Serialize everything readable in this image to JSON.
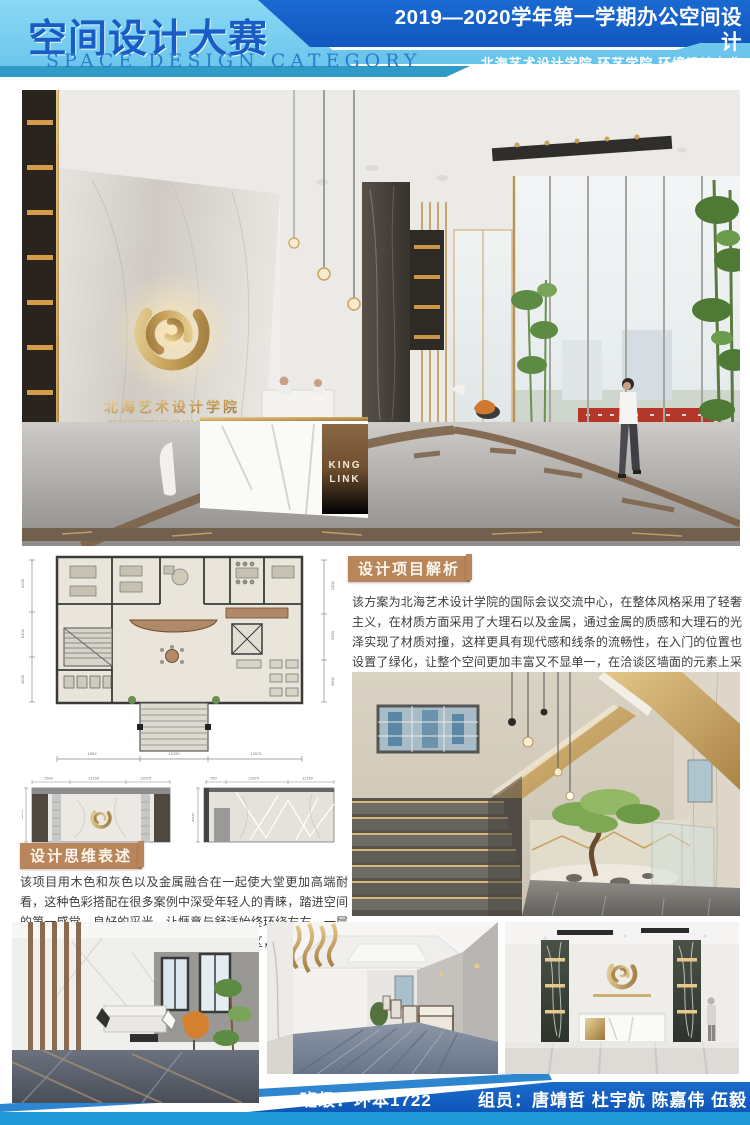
{
  "header": {
    "title_cn": "空间设计大赛",
    "title_en": "SPACE DESIGN CATEGORY",
    "course_line": "2019—2020学年第一学期办公空间设计",
    "school_line": "北海艺术设计学院 环艺学院 环境设计专业"
  },
  "brand": {
    "logo_name_cn": "北海艺术设计学院",
    "logo_name_en": "BEIHAI UNIVERSITY OF ART AND DESIGN",
    "desk_sign_line1": "KING",
    "desk_sign_line2": "LINK"
  },
  "sections": {
    "analysis": {
      "label": "设计项目解析",
      "body": "该方案为北海艺术设计学院的国际会议交流中心，在整体风格采用了轻奢主义，在材质方面采用了大理石以及金属，通过金属的质感和大理石的光泽实现了材质对撞，这样更具有现代感和线条的流畅性，在入门的位置也设置了绿化，让整个空间更加丰富又不显单一，在洽谈区墙面的元素上采用了多边形切割的方式。"
    },
    "thinking": {
      "label": "设计思维表述",
      "body": "该项目用木色和灰色以及金属融合在一起使大堂更加高端耐看，这种色彩搭配在很多案例中深受年轻人的青睐，踏进空间的第一感觉，良好的采光，让惬意与舒适始终环绕左右，一层主要分为客户接待区、等候区以及大堂展示区，在楼梯入口处也添加了植物配景，凸显大自然的元素。"
    }
  },
  "floor_plan": {
    "bottom_dims": [
      "1500",
      "12150",
      "13575"
    ],
    "left_dims": [
      "4200",
      "8100",
      "4500"
    ],
    "right_dims": [
      "2400",
      "9300",
      "3900"
    ]
  },
  "elevations": {
    "left": {
      "top_dims": [
        "1500",
        "12150",
        "13575"
      ],
      "side_dim": "2800"
    },
    "right": {
      "top_dims": [
        "750",
        "13575",
        "12150"
      ],
      "side_dim": "3000"
    }
  },
  "footer": {
    "class_label": "班级：环本1722",
    "members_label": "组员：唐靖哲 杜宇航 陈嘉伟 伍毅"
  },
  "colors": {
    "header_light": "#82D2F0",
    "header_dark": "#1561C9",
    "header_cyan": "#2F9BC6",
    "accent_gold": "#C9A35C",
    "label_tan": "#B9855A",
    "footer_band": "#1565C6",
    "footer_stripe": "#209BD8"
  }
}
